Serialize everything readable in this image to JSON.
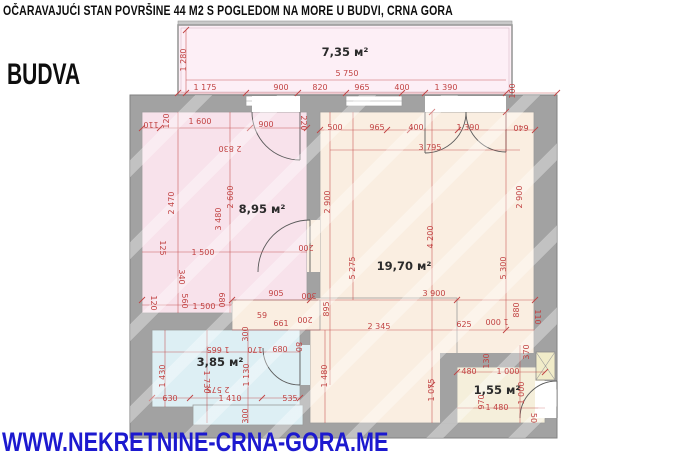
{
  "header": {
    "title": "OČARAVAJUĆI STAN POVRŠINE 44 M2 S POGLEDOM NA MORE U BUDVI, CRNA GORA",
    "city": "BUDVA"
  },
  "footer": {
    "website": "WWW.NEKRETNINE-CRNA-GORA.ME"
  },
  "colors": {
    "title_text": "#0e0e0e",
    "website_blue": "#1c19cf",
    "dimension_red": "#c14343",
    "wall_gray": "#a2a2a2",
    "balcony_fill": "#fdeff6",
    "bedroom_fill": "#f8e2eb",
    "living_fill": "#faeee1",
    "bathroom_fill": "#ddeff4",
    "entry_fill": "#f5efdb"
  },
  "plan": {
    "rooms": [
      {
        "name": "balcony",
        "label": "7,35 м²",
        "x": 345,
        "y": 52
      },
      {
        "name": "bedroom",
        "label": "8,95 м²",
        "x": 262,
        "y": 209
      },
      {
        "name": "living-room",
        "label": "19,70 м²",
        "x": 404,
        "y": 266
      },
      {
        "name": "bathroom",
        "label": "3,85 м²",
        "x": 220,
        "y": 362
      },
      {
        "name": "entry",
        "label": "1,55 м²",
        "x": 497,
        "y": 390
      }
    ],
    "dimensions": [
      {
        "t": "1 280",
        "x": 184,
        "y": 60,
        "r": -90
      },
      {
        "t": "5 750",
        "x": 347,
        "y": 74
      },
      {
        "t": "1 175",
        "x": 205,
        "y": 88
      },
      {
        "t": "900",
        "x": 281,
        "y": 88
      },
      {
        "t": "820",
        "x": 320,
        "y": 88
      },
      {
        "t": "965",
        "x": 362,
        "y": 88
      },
      {
        "t": "400",
        "x": 402,
        "y": 88
      },
      {
        "t": "1 390",
        "x": 446,
        "y": 88
      },
      {
        "t": "100",
        "x": 513,
        "y": 91,
        "r": -90
      },
      {
        "t": "110",
        "x": 151,
        "y": 124,
        "r": 180
      },
      {
        "t": "120",
        "x": 167,
        "y": 121,
        "r": -90
      },
      {
        "t": "1 600",
        "x": 200,
        "y": 122
      },
      {
        "t": "900",
        "x": 266,
        "y": 125
      },
      {
        "t": "220",
        "x": 303,
        "y": 123,
        "r": 90
      },
      {
        "t": "2 830",
        "x": 230,
        "y": 148,
        "r": 180
      },
      {
        "t": "2 470",
        "x": 172,
        "y": 203,
        "r": -90
      },
      {
        "t": "2 600",
        "x": 231,
        "y": 197,
        "r": -90
      },
      {
        "t": "3 480",
        "x": 219,
        "y": 219,
        "r": -90
      },
      {
        "t": "125",
        "x": 162,
        "y": 248,
        "r": 90
      },
      {
        "t": "1 500",
        "x": 203,
        "y": 253
      },
      {
        "t": "340",
        "x": 181,
        "y": 277,
        "r": 90
      },
      {
        "t": "120",
        "x": 153,
        "y": 303,
        "r": 90
      },
      {
        "t": "560",
        "x": 184,
        "y": 301,
        "r": 90
      },
      {
        "t": "1 500",
        "x": 204,
        "y": 307
      },
      {
        "t": "680",
        "x": 221,
        "y": 300,
        "r": 90
      },
      {
        "t": "500",
        "x": 335,
        "y": 128
      },
      {
        "t": "2 900",
        "x": 328,
        "y": 202,
        "r": -90
      },
      {
        "t": "200",
        "x": 306,
        "y": 247,
        "r": 180
      },
      {
        "t": "5 275",
        "x": 353,
        "y": 268,
        "r": -90
      },
      {
        "t": "300",
        "x": 309,
        "y": 295,
        "r": 180
      },
      {
        "t": "895",
        "x": 327,
        "y": 309,
        "r": -90
      },
      {
        "t": "200",
        "x": 305,
        "y": 319,
        "r": 180
      },
      {
        "t": "905",
        "x": 276,
        "y": 294
      },
      {
        "t": "59",
        "x": 262,
        "y": 316
      },
      {
        "t": "661",
        "x": 281,
        "y": 324
      },
      {
        "t": "170",
        "x": 255,
        "y": 349,
        "r": 180
      },
      {
        "t": "680",
        "x": 280,
        "y": 350
      },
      {
        "t": "80",
        "x": 298,
        "y": 347,
        "r": 90
      },
      {
        "t": "965",
        "x": 377,
        "y": 128
      },
      {
        "t": "400",
        "x": 416,
        "y": 128
      },
      {
        "t": "1 390",
        "x": 468,
        "y": 128
      },
      {
        "t": "640",
        "x": 521,
        "y": 127,
        "r": 180
      },
      {
        "t": "3 795",
        "x": 430,
        "y": 148
      },
      {
        "t": "2 900",
        "x": 520,
        "y": 197,
        "r": -90
      },
      {
        "t": "4 200",
        "x": 431,
        "y": 237,
        "r": -90
      },
      {
        "t": "5 300",
        "x": 504,
        "y": 268,
        "r": -90
      },
      {
        "t": "3 900",
        "x": 434,
        "y": 294
      },
      {
        "t": "2 345",
        "x": 379,
        "y": 327
      },
      {
        "t": "625",
        "x": 464,
        "y": 325
      },
      {
        "t": "1 000",
        "x": 497,
        "y": 321,
        "r": 180
      },
      {
        "t": "880",
        "x": 517,
        "y": 310,
        "r": -90
      },
      {
        "t": "110",
        "x": 537,
        "y": 317,
        "r": 90
      },
      {
        "t": "1 480",
        "x": 325,
        "y": 376,
        "r": -90
      },
      {
        "t": "1 075",
        "x": 432,
        "y": 390,
        "r": -90
      },
      {
        "t": "300",
        "x": 246,
        "y": 334,
        "r": -90
      },
      {
        "t": "1 665",
        "x": 218,
        "y": 349,
        "r": 180
      },
      {
        "t": "1 430",
        "x": 163,
        "y": 376,
        "r": -90
      },
      {
        "t": "1 730",
        "x": 206,
        "y": 382,
        "r": 90
      },
      {
        "t": "1 130",
        "x": 247,
        "y": 375,
        "r": -90
      },
      {
        "t": "2 575",
        "x": 218,
        "y": 389,
        "r": 180
      },
      {
        "t": "630",
        "x": 170,
        "y": 399
      },
      {
        "t": "1 410",
        "x": 230,
        "y": 399
      },
      {
        "t": "535",
        "x": 290,
        "y": 399
      },
      {
        "t": "300",
        "x": 246,
        "y": 416,
        "r": -90
      },
      {
        "t": "370",
        "x": 527,
        "y": 352,
        "r": -90
      },
      {
        "t": "130",
        "x": 487,
        "y": 361,
        "r": -90
      },
      {
        "t": "480",
        "x": 469,
        "y": 372
      },
      {
        "t": "1 000",
        "x": 508,
        "y": 372
      },
      {
        "t": "1 000",
        "x": 522,
        "y": 393,
        "r": -90
      },
      {
        "t": "970",
        "x": 482,
        "y": 402,
        "r": -90
      },
      {
        "t": "1 480",
        "x": 497,
        "y": 408
      },
      {
        "t": "50",
        "x": 533,
        "y": 418,
        "r": 90
      }
    ]
  }
}
